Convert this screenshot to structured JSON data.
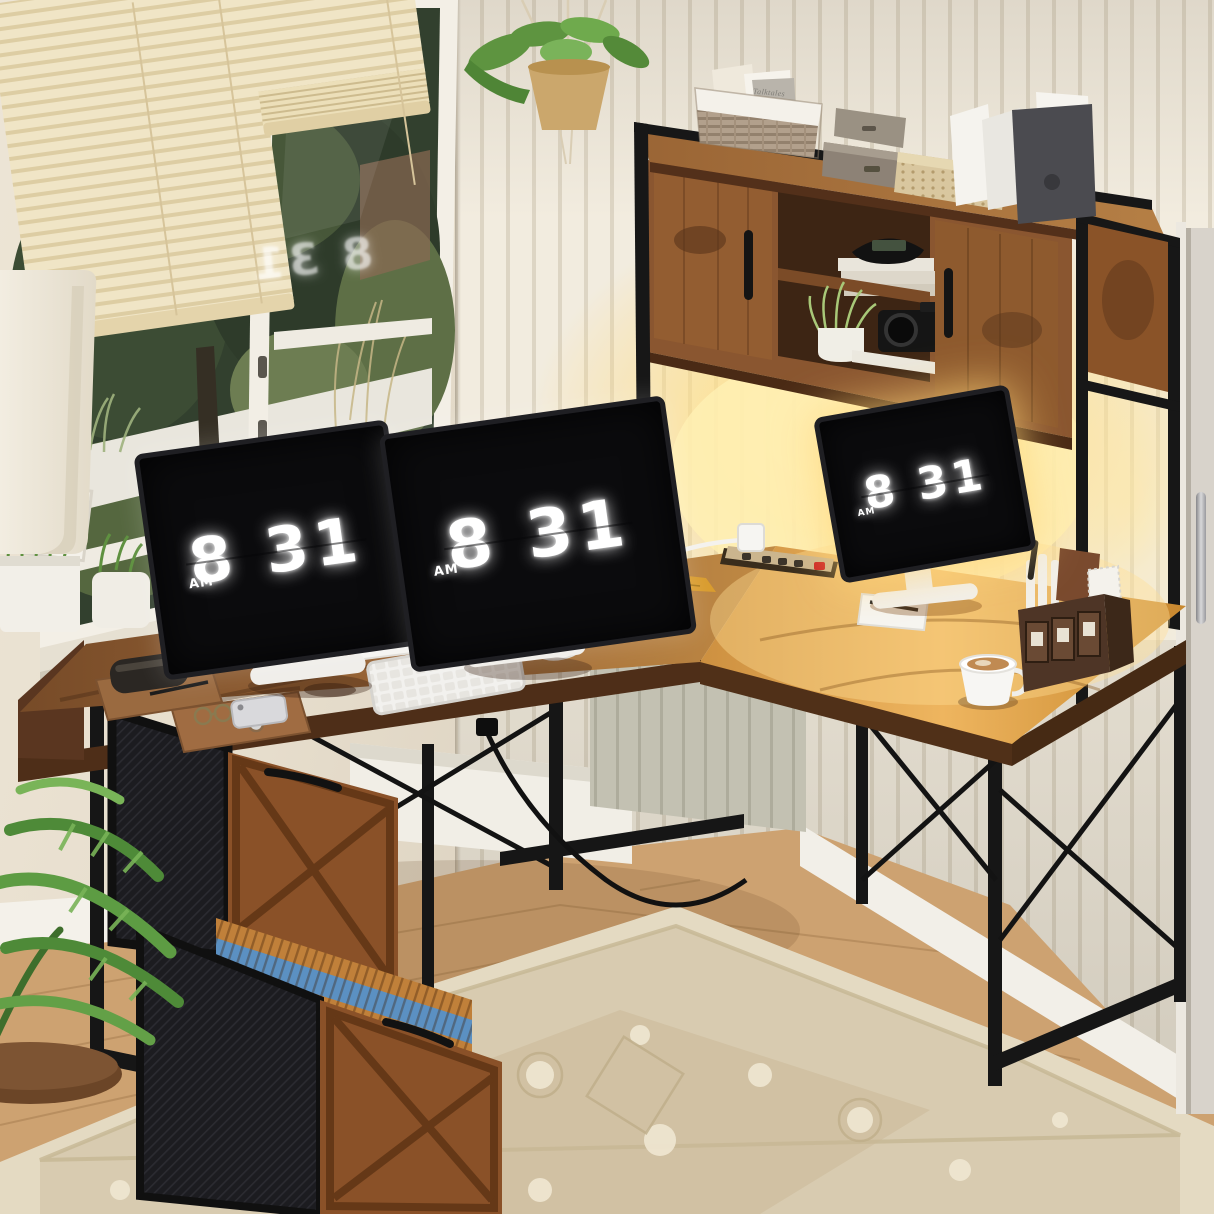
{
  "scene": {
    "type": "product-photo",
    "subject": "Rustic L-shaped computer desk with hutch, warm LED backlight, built-in power strip and two-drawer file cabinet in a sunlit home office",
    "room": "home office",
    "lighting": "warm LED glow under hutch plus daylight from window"
  },
  "clocks": {
    "monitor_left": {
      "meridiem": "AM",
      "time": "8 31"
    },
    "monitor_center": {
      "meridiem": "AM",
      "time": "8 31"
    },
    "monitor_right": {
      "meridiem": "AM",
      "time": "8 31"
    },
    "window_reflection": {
      "time": "8 31"
    }
  },
  "decor_text": {
    "basket_book_title": "Talktales"
  },
  "palette": {
    "desk_wood": "#8a5a33",
    "desk_wood_lit": "#e2a952",
    "metal_frame": "#161616",
    "led_glow": "#ffdf8e",
    "wall_panel": "#f1ebe0",
    "wall_left": "#e9e1d3",
    "blinds": "#f0e5c6",
    "rug": "#ddd2ba",
    "floor": "#cda271",
    "screen": "#0b0b0d",
    "clock_digits": "#ffffff",
    "file_folder_blue": "#5b90c2",
    "file_folder_orange": "#c0803a"
  },
  "scene_objects": [
    "window with cream venetian blinds and garden view",
    "hanging macrame planter",
    "white floor lamp shade",
    "windowsill planters and picture frame",
    "hutch with two barn doors and open shelves",
    "wicker storage basket with books",
    "stacked gray boxes",
    "rattan storage box",
    "magazine file holders with papers",
    "flip-clock display on three monitors",
    "white keyboard and mouse",
    "gold-lit laptop with charging cable",
    "recessed power strip with red switch",
    "wooden desk trays with glasses, phone and watch",
    "desk organizer caddy with pens",
    "white coffee cup with latte",
    "two-drawer file cabinet with hanging folders",
    "palm plant with round wood base",
    "beige oriental rug on wood floor",
    "gray door with steel handle"
  ]
}
